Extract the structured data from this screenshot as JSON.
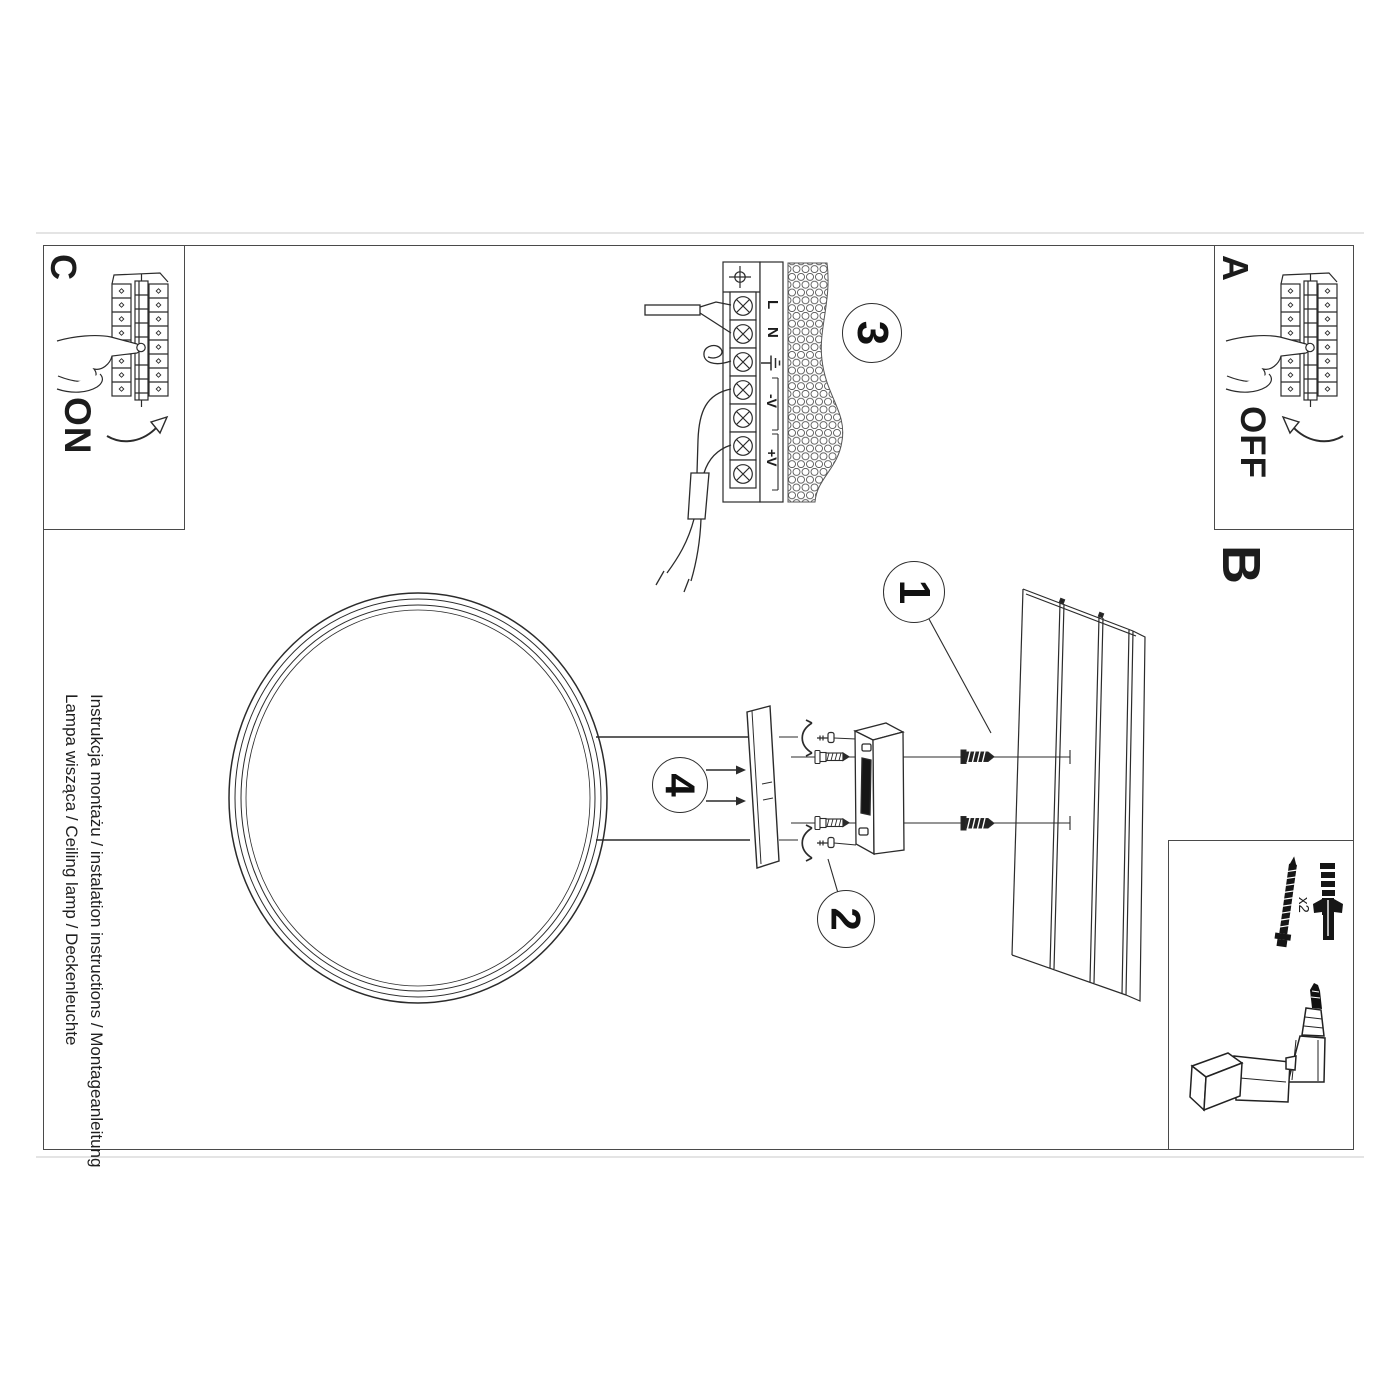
{
  "document": {
    "footer_line1": "Instrukcja montażu / instalation instructions / Montageanleitung",
    "footer_line2": "Lampa wisząca / Ceiling lamp / Deckenleuchte"
  },
  "panels": {
    "a": {
      "label": "A",
      "state": "OFF"
    },
    "b": {
      "label": "B"
    },
    "c": {
      "label": "C",
      "state": "ON"
    }
  },
  "steps": {
    "s1": "1",
    "s2": "2",
    "s3": "3",
    "s4": "4"
  },
  "wiring": {
    "live": "L",
    "neutral": "N",
    "v_minus": "-V",
    "v_plus": "+V"
  },
  "hardware": {
    "anchor_quantity": "x2"
  },
  "icons": {
    "earth": "earth-ground-icon",
    "position_cross": "position-cross-icon",
    "pressing_hand": "pressing-hand-icon",
    "curved_arrow_on": "curved-arrow-up-right-icon",
    "curved_arrow_off": "curved-arrow-up-left-icon",
    "screw": "screw-icon",
    "wall_plug": "wall-plug-icon",
    "drill": "drill-icon"
  },
  "colors": {
    "paper": "#ffffff",
    "ink": "#2b2b2b",
    "frame": "#4a4a4a",
    "hatch": "#555555"
  }
}
